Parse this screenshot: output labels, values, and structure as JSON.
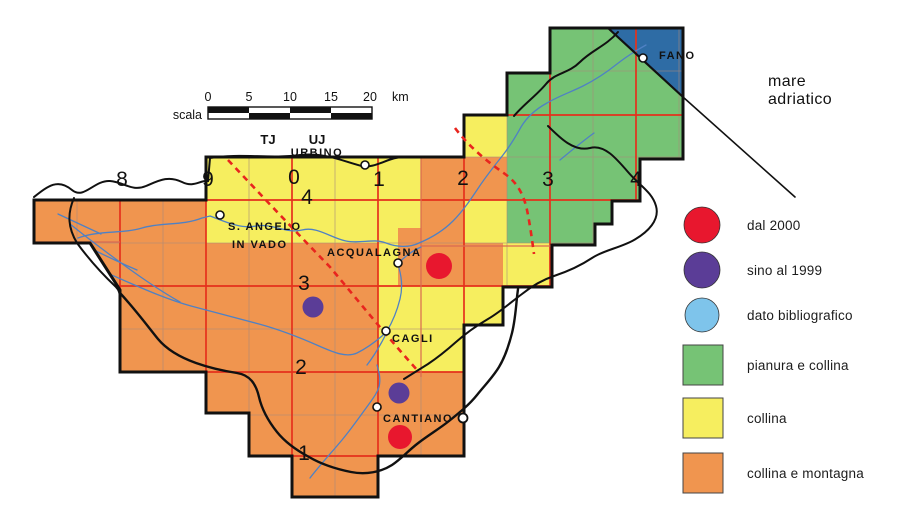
{
  "colors": {
    "orange": "#F0954F",
    "yellow": "#F6EE5F",
    "green": "#76C375",
    "sea": "#2E6CA5",
    "grid_red": "#E5311C",
    "subgrid": "#A98A7B",
    "dashed_red": "#E8251E",
    "record_red": "#E8172E",
    "record_purple": "#5B3D97",
    "record_blue": "#7EC4EB",
    "river": "#4F81C4",
    "ink": "#111111"
  },
  "map": {
    "scale": {
      "caption": "scala",
      "ticks": [
        "0",
        "5",
        "10",
        "15",
        "20"
      ],
      "unit": "km"
    },
    "utm_zones": [
      "TJ",
      "UJ"
    ],
    "grid": {
      "columns": [
        "8",
        "9",
        "0",
        "1",
        "2",
        "3",
        "4"
      ],
      "rows": [
        "4",
        "3",
        "2",
        "1"
      ]
    },
    "sea": {
      "line1": "mare",
      "line2": "adriatico"
    },
    "towns": {
      "fano": {
        "name": "FANO"
      },
      "urbino": {
        "name": "URBINO"
      },
      "sangelo": {
        "line1": "S. ANGELO",
        "line2": "IN VADO"
      },
      "acqualagna": {
        "name": "ACQUALAGNA"
      },
      "cagli": {
        "name": "CAGLI"
      },
      "cantiano": {
        "name": "CANTIANO"
      }
    }
  },
  "records": [
    {
      "period": "dal 2000",
      "nearest_town": "Acqualagna"
    },
    {
      "period": "sino al 1999",
      "nearest_town": "Cagli (ovest)"
    },
    {
      "period": "sino al 1999",
      "nearest_town": "Cantiano (nord)"
    },
    {
      "period": "dal 2000",
      "nearest_town": "Cantiano"
    }
  ],
  "legend": {
    "items": [
      {
        "label": "dal 2000",
        "color": "#E8172E",
        "shape": "circle"
      },
      {
        "label": "sino al 1999",
        "color": "#5B3D97",
        "shape": "circle"
      },
      {
        "label": "dato bibliografico",
        "color": "#7EC4EB",
        "shape": "circle"
      },
      {
        "label": "pianura e collina",
        "color": "#76C375",
        "shape": "square"
      },
      {
        "label": "collina",
        "color": "#F6EE5F",
        "shape": "square"
      },
      {
        "label": "collina e montagna",
        "color": "#F0954F",
        "shape": "square"
      }
    ]
  }
}
